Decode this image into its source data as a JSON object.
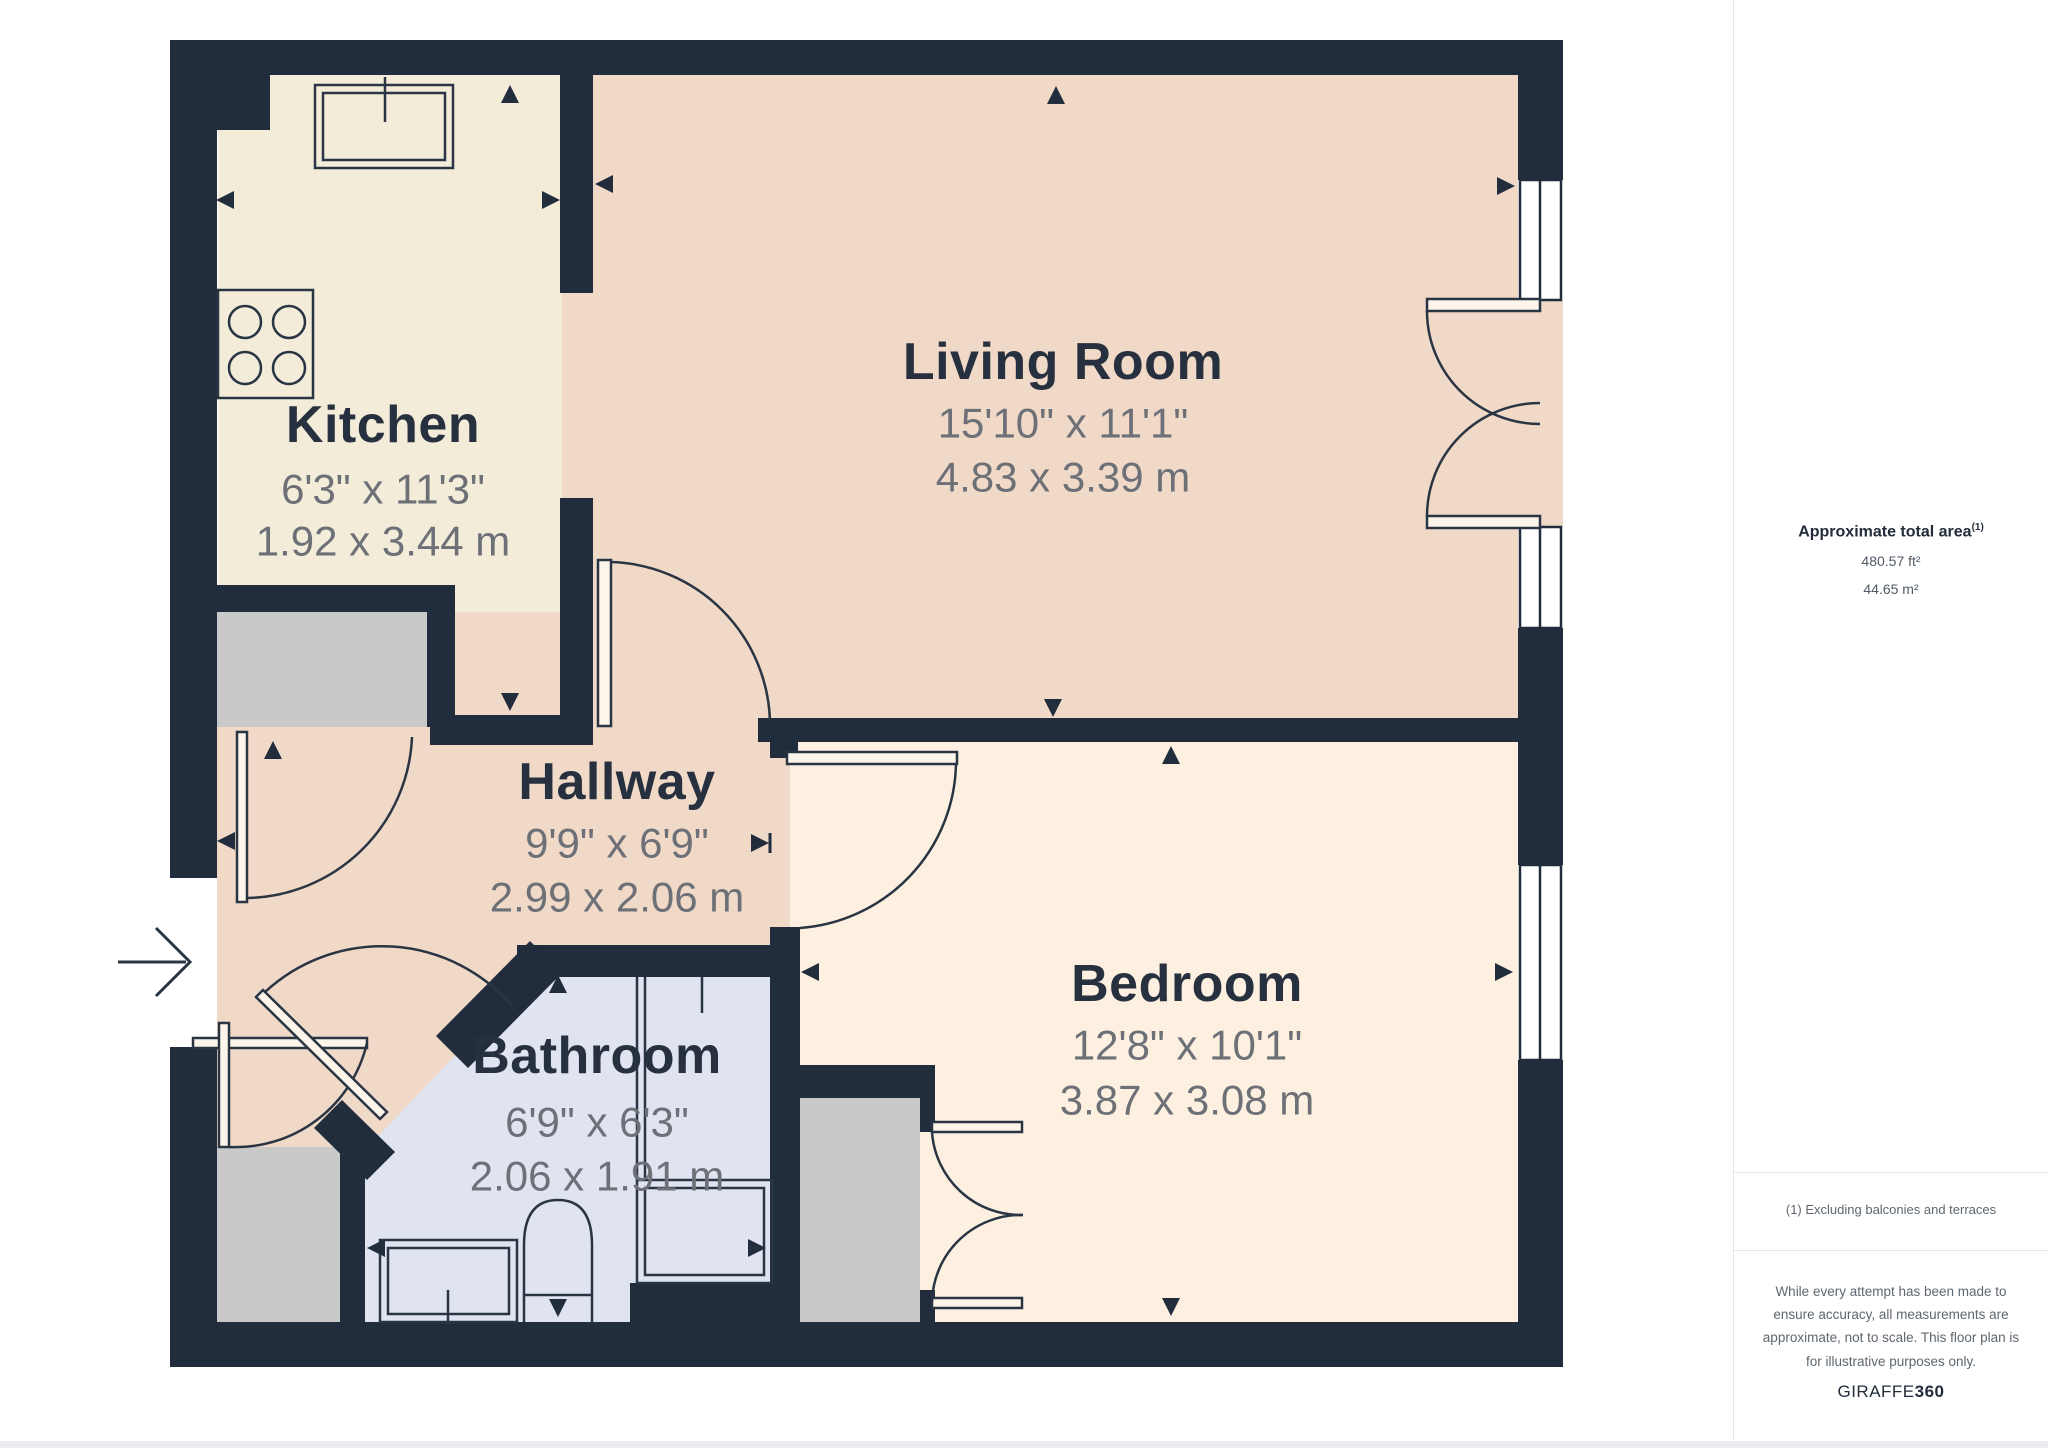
{
  "rooms": [
    {
      "name": "Kitchen",
      "imperial": "6'3\" x 11'3\"",
      "metric": "1.92 x 3.44 m"
    },
    {
      "name": "Living Room",
      "imperial": "15'10\" x 11'1\"",
      "metric": "4.83 x 3.39 m"
    },
    {
      "name": "Hallway",
      "imperial": "9'9\" x 6'9\"",
      "metric": "2.99 x 2.06 m"
    },
    {
      "name": "Bathroom",
      "imperial": "6'9\" x 6'3\"",
      "metric": "2.06 x 1.91 m"
    },
    {
      "name": "Bedroom",
      "imperial": "12'8\" x 10'1\"",
      "metric": "3.87 x 3.08 m"
    }
  ],
  "sidebar": {
    "area_title": "Approximate total area",
    "area_superscript": "(1)",
    "area_ft": "480.57 ft²",
    "area_m": "44.65 m²",
    "footnote": "(1) Excluding balconies and terraces",
    "disclaimer": "While every attempt has been made to ensure accuracy, all measurements are approximate, not to scale. This floor plan is for illustrative purposes only.",
    "brand": "GIRAFFE",
    "brand_bold": "360"
  },
  "colors": {
    "wall": "#212c3d",
    "kitchen_floor": "#f2ecd9",
    "living_floor": "#f1d9c8",
    "bedroom_floor": "#fdf0e0",
    "bathroom_floor": "#e0e4f0",
    "closet_gray": "#c9c9c9",
    "line": "#2a3544",
    "title_text": "#26303e",
    "dim_text": "#6d7177"
  }
}
